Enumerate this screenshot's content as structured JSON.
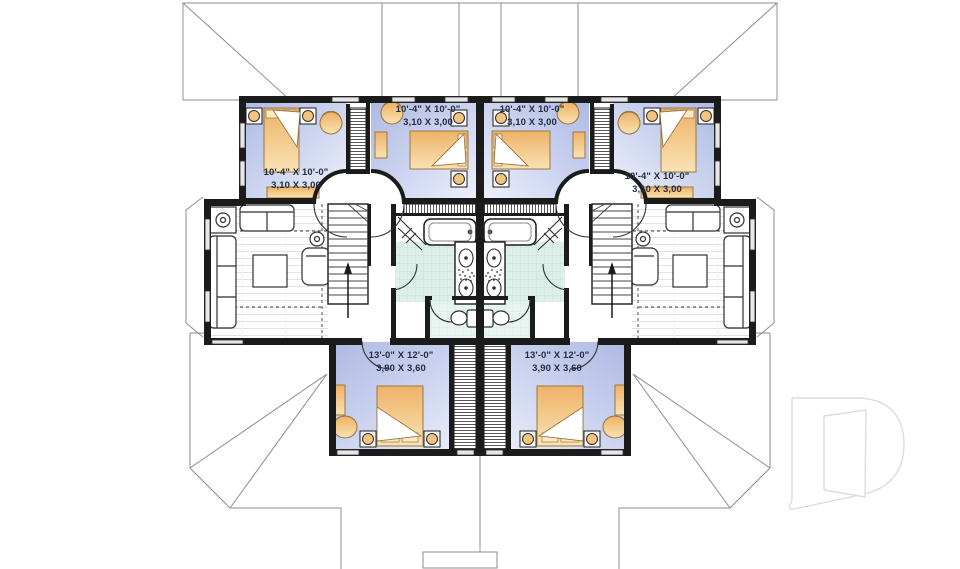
{
  "labels": {
    "rooms": [
      {
        "id": "bedroom-upper-left-outer",
        "imperial": "10'-4\" X 10'-0\"",
        "metric": "3,10 X 3,00"
      },
      {
        "id": "bedroom-upper-left-inner",
        "imperial": "10'-4\" X 10'-0\"",
        "metric": "3,10 X 3,00"
      },
      {
        "id": "bedroom-upper-right-inner",
        "imperial": "10'-4\" X 10'-0\"",
        "metric": "3,10 X 3,00"
      },
      {
        "id": "bedroom-upper-right-outer",
        "imperial": "10'-4\" X 10'-0\"",
        "metric": "3,10 X 3,00"
      },
      {
        "id": "bedroom-lower-left",
        "imperial": "13'-0\" X 12'-0\"",
        "metric": "3,90 X 3,60"
      },
      {
        "id": "bedroom-lower-right",
        "imperial": "13'-0\" X 12'-0\"",
        "metric": "3,90 X 3,60"
      }
    ]
  },
  "logo": {
    "glyph": "D"
  },
  "colors": {
    "wall": "#1b1b1b",
    "bedroom_fill": "#c3cceb",
    "furniture_accent": "#f2bc74",
    "bath_tile": "#dcebe4",
    "roof_line": "#8d8d8d",
    "label_text": "#262b3d",
    "logo_outline": "#dcdcdc"
  }
}
